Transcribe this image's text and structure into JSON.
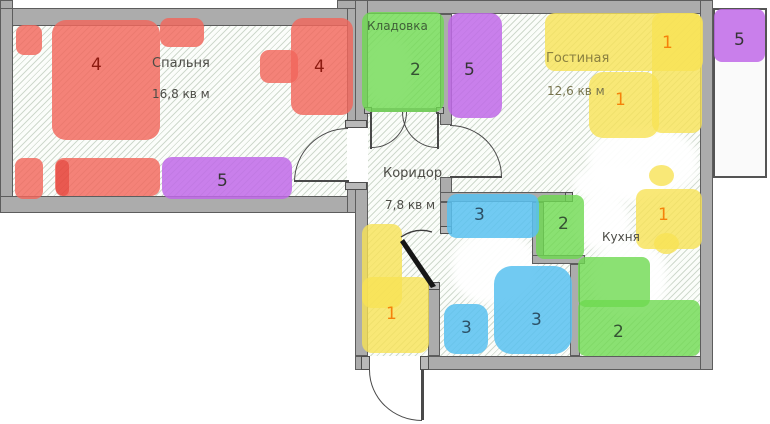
{
  "rooms": {
    "bedroom": {
      "label": "Спальня",
      "area": "16,8 кв м"
    },
    "closet": {
      "label": "Кладовка"
    },
    "living": {
      "label": "Гостиная",
      "area": "12,6 кв м"
    },
    "corridor": {
      "label": "Коридор",
      "area": "7,8 кв м"
    },
    "kitchen": {
      "label": "Кухня"
    }
  },
  "markers": {
    "bed_left": "4",
    "bed_right": "4",
    "bed_bottom": "5",
    "living_wardrobe": "5",
    "balcony": "5",
    "closet": "2",
    "kitchen_niche": "2",
    "kitchen_floor": "2",
    "bath_top": "3",
    "bath_left": "3",
    "bath_right": "3",
    "corridor": "1",
    "living_top": "1",
    "living_mid": "1",
    "kitchen_right": "1"
  },
  "colors": {
    "zone_red": "#f2675c",
    "zone_purple": "#c069e8",
    "zone_green": "#6ed950",
    "zone_blue": "#58c1f0",
    "zone_yellow": "#f7e255",
    "wall": "#acacac",
    "hatch": "#cfd9cd",
    "number_red": "#8c1a10",
    "number_orange": "#f5820a"
  }
}
